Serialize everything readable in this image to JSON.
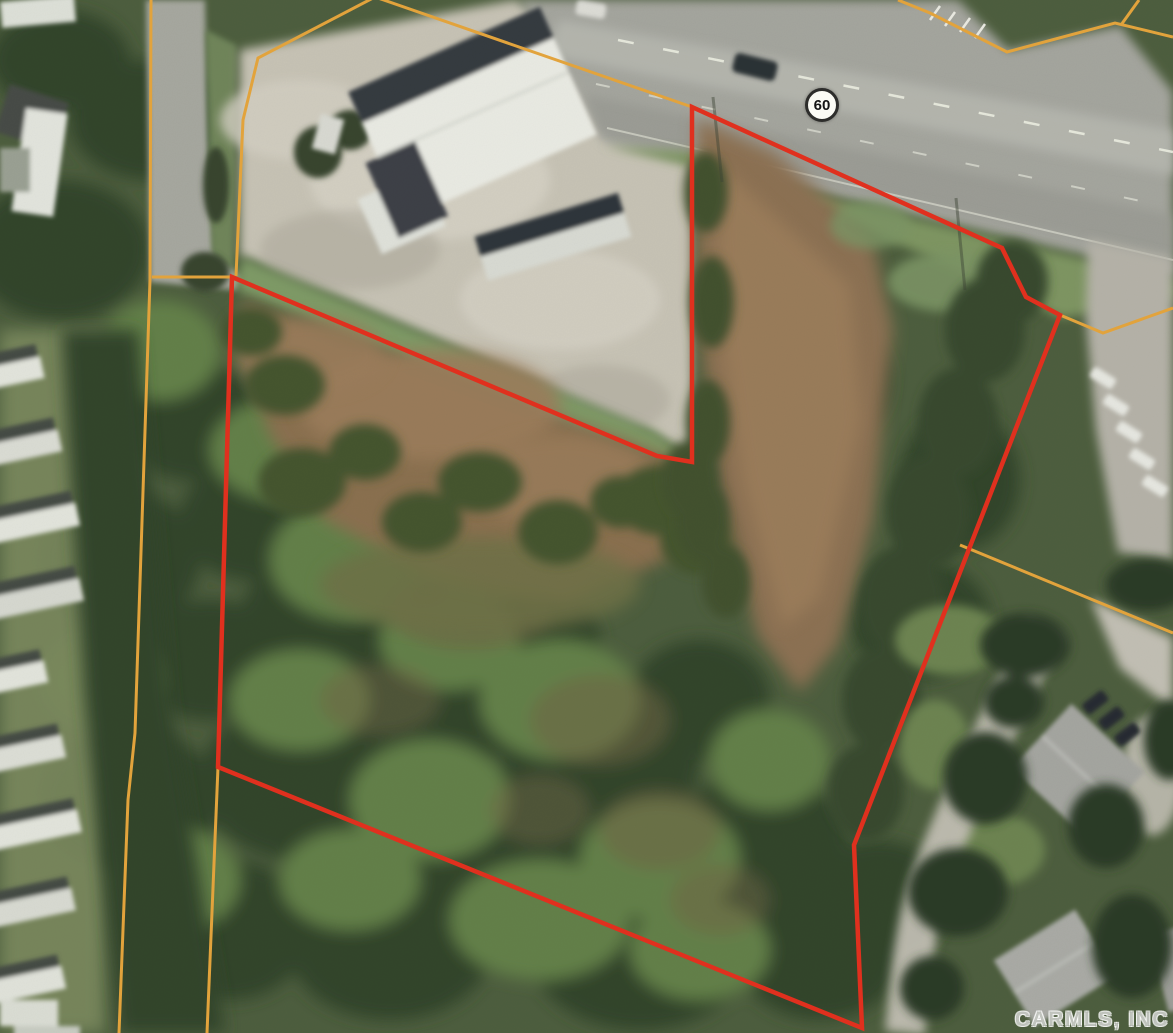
{
  "map": {
    "description": "Aerial parcel map: subject property outlined in red, adjacent parcel boundaries in orange, Highway 60 at top",
    "watermark": "CARMLS, INC",
    "highway_shield": {
      "label": "60",
      "cx": 822,
      "cy": 105,
      "diameter": 34
    },
    "colors": {
      "subject_boundary": "#e0301e",
      "adjacent_boundary": "#e2a33c"
    },
    "subject_parcel_boundary": {
      "stroke_width": 4.5,
      "points": [
        [
          692,
          107
        ],
        [
          1002,
          248
        ],
        [
          1026,
          297
        ],
        [
          1060,
          315
        ],
        [
          854,
          845
        ],
        [
          862,
          1028
        ],
        [
          218,
          767
        ],
        [
          232,
          277
        ],
        [
          657,
          456
        ],
        [
          692,
          462
        ]
      ]
    },
    "adjacent_parcel_boundaries": [
      {
        "points": [
          [
            151,
            0
          ],
          [
            150,
            280
          ],
          [
            135,
            733
          ],
          [
            128,
            800
          ],
          [
            119,
            1033
          ]
        ]
      },
      {
        "points": [
          [
            152,
            277
          ],
          [
            232,
            277
          ]
        ]
      },
      {
        "points": [
          [
            375,
            -3
          ],
          [
            258,
            58
          ],
          [
            243,
            120
          ],
          [
            236,
            276
          ]
        ]
      },
      {
        "points": [
          [
            375,
            -3
          ],
          [
            692,
            107
          ]
        ]
      },
      {
        "points": [
          [
            218,
            767
          ],
          [
            207,
            1033
          ]
        ]
      },
      {
        "points": [
          [
            898,
            0
          ],
          [
            930,
            13
          ],
          [
            1007,
            52
          ],
          [
            1115,
            23
          ],
          [
            1173,
            37
          ]
        ]
      },
      {
        "points": [
          [
            1139,
            0
          ],
          [
            1121,
            25
          ]
        ]
      },
      {
        "points": [
          [
            1060,
            315
          ],
          [
            1103,
            333
          ],
          [
            1173,
            308
          ]
        ]
      },
      {
        "points": [
          [
            960,
            545
          ],
          [
            1173,
            633
          ]
        ]
      }
    ]
  }
}
